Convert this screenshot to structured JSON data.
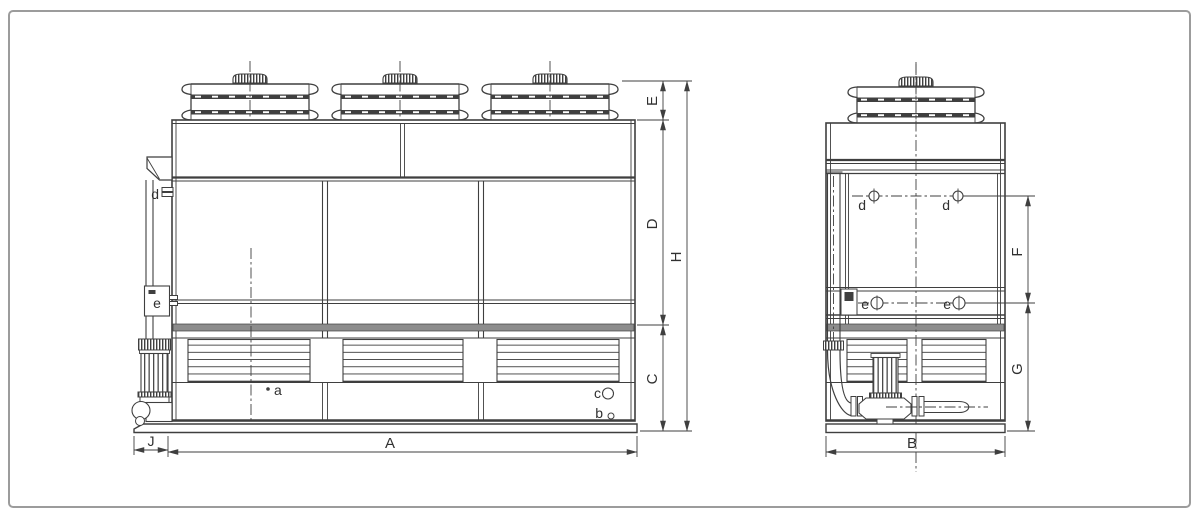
{
  "drawing": {
    "type": "technical-drawing",
    "subject": "closed circuit cooling tower - front and side orthographic views with dimension letters",
    "colors": {
      "line": "#3f3f3f",
      "band": "#8d8d8d",
      "background": "#ffffff",
      "frame_border": "#9c9c9c"
    },
    "front_view": {
      "dims": {
        "A": "A",
        "C": "C",
        "D": "D",
        "E": "E",
        "H": "H",
        "J": "J"
      },
      "ports": {
        "a": "a",
        "b": "b",
        "c": "c",
        "d": "d",
        "e": "e"
      }
    },
    "side_view": {
      "dims": {
        "B": "B",
        "F": "F",
        "G": "G"
      },
      "ports": {
        "d1": "d",
        "d2": "d",
        "e1": "e",
        "e2": "e"
      }
    }
  }
}
